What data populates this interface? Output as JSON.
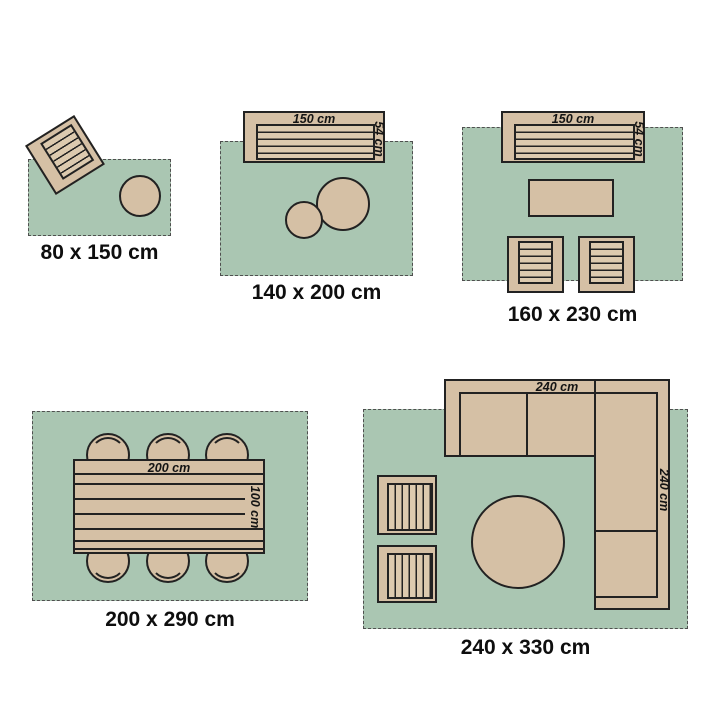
{
  "title": "Rug size guide with furniture layouts",
  "colors": {
    "background": "#ffffff",
    "rug": "#aac6b2",
    "rug_border": "#4f4f4f",
    "furniture": "#d5c0a5",
    "furniture_inner": "#dccaaf",
    "outline": "#222222",
    "text": "#0e0e0e"
  },
  "panels": [
    {
      "size_caption": "80 x 150 cm",
      "furniture": [
        "rotated armchair",
        "round side table"
      ]
    },
    {
      "size_caption": "140 x 200 cm",
      "furniture": [
        "sofa",
        "large round coffee table",
        "small round coffee table"
      ],
      "sofa_width_label": "150 cm",
      "sofa_depth_label": "54 cm"
    },
    {
      "size_caption": "160 x 230 cm",
      "furniture": [
        "sofa",
        "rectangular coffee table",
        "armchair",
        "armchair"
      ],
      "sofa_width_label": "150 cm",
      "sofa_depth_label": "54 cm"
    },
    {
      "size_caption": "200 x 290 cm",
      "furniture": [
        "dining table",
        "six chairs"
      ],
      "table_width_label": "200 cm",
      "table_depth_label": "100 cm"
    },
    {
      "size_caption": "240 x 330 cm",
      "furniture": [
        "corner sofa",
        "two armchairs",
        "round table"
      ],
      "sofa_width_label": "240 cm",
      "sofa_depth_label": "240 cm"
    }
  ]
}
